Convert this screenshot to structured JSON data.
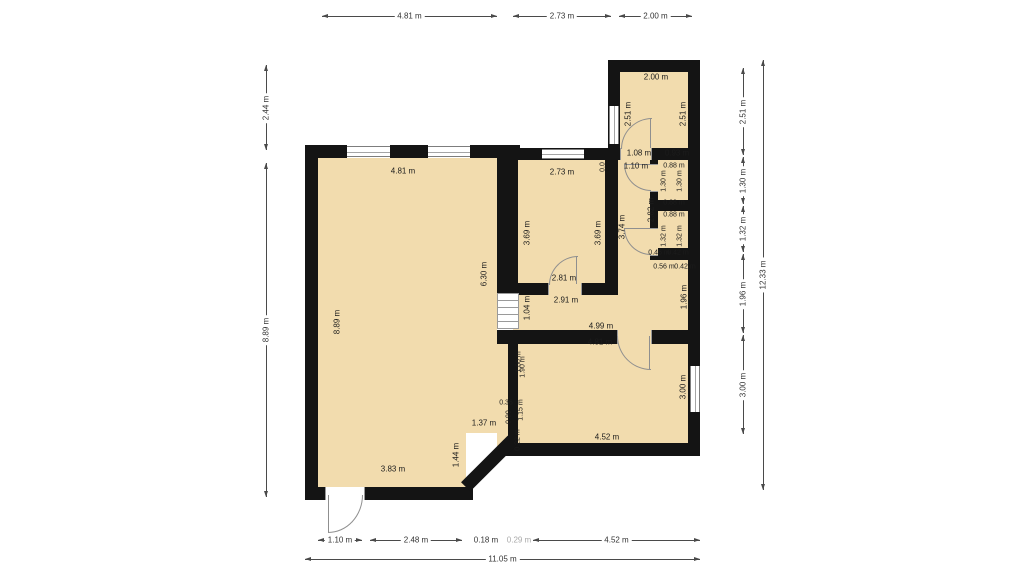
{
  "dims": {
    "top": [
      "4.81 m",
      "2.73 m",
      "2.00 m"
    ],
    "left": [
      "2.44 m",
      "8.89 m"
    ],
    "right": [
      "2.51 m",
      "1.30 m",
      "1.32 m",
      "1.96 m",
      "3.00 m"
    ],
    "right_total": "12.33 m",
    "bottom": [
      "1.10 m",
      "2.48 m",
      "0.18 m",
      "0.29 m",
      "4.52 m"
    ],
    "bottom_total": "11.05 m"
  },
  "plan": {
    "living": {
      "width": "4.81 m",
      "height": "8.89 m",
      "inner_height": "6.30 m",
      "bottom_width": "3.83 m",
      "diagonal": "1.44 m",
      "notch_width": "1.37 m",
      "notch_a": "0.36",
      "notch_b": "0.90",
      "notch_c": "1.15 m",
      "notch_d": "0.22 m",
      "edge_a": "1.60 m",
      "edge_b": "1.90 m"
    },
    "room_mid": {
      "width": "2.73 m",
      "left_height": "3.69 m",
      "right_height": "3.69 m",
      "door_width": "2.81 m",
      "opening_width": "2.91 m",
      "sliver": "0.0"
    },
    "corridor": {
      "door_width": "1.10 m",
      "height_a": "2.82 m",
      "height_b": "3.74 m"
    },
    "room_top_right": {
      "width": "2.00 m",
      "left_height": "2.51 m",
      "right_height": "2.51 m",
      "door_width": "1.08 m",
      "wall_width": "0.93 m"
    },
    "closet_top": {
      "top_width": "0.88 m",
      "left_height": "1.30 m",
      "right_height": "1.30 m",
      "bottom_width": "0.88 m"
    },
    "closet_bottom": {
      "top_width": "0.88 m",
      "left_height": "1.32 m",
      "right_height": "1.32 m",
      "bottom_a": "0.46 m",
      "bottom_b": "0.42 m",
      "below_a": "0.56 m",
      "below_b": "0.42 m"
    },
    "hall": {
      "height": "1.04 m",
      "width": "4.99 m",
      "right_height": "1.96 m"
    },
    "room_bottom_right": {
      "top_width": "4.81 m",
      "right_height": "3.00 m",
      "bottom_width": "4.52 m"
    }
  },
  "colors": {
    "wall": "#141414",
    "room_fill": "#f2dcae"
  }
}
